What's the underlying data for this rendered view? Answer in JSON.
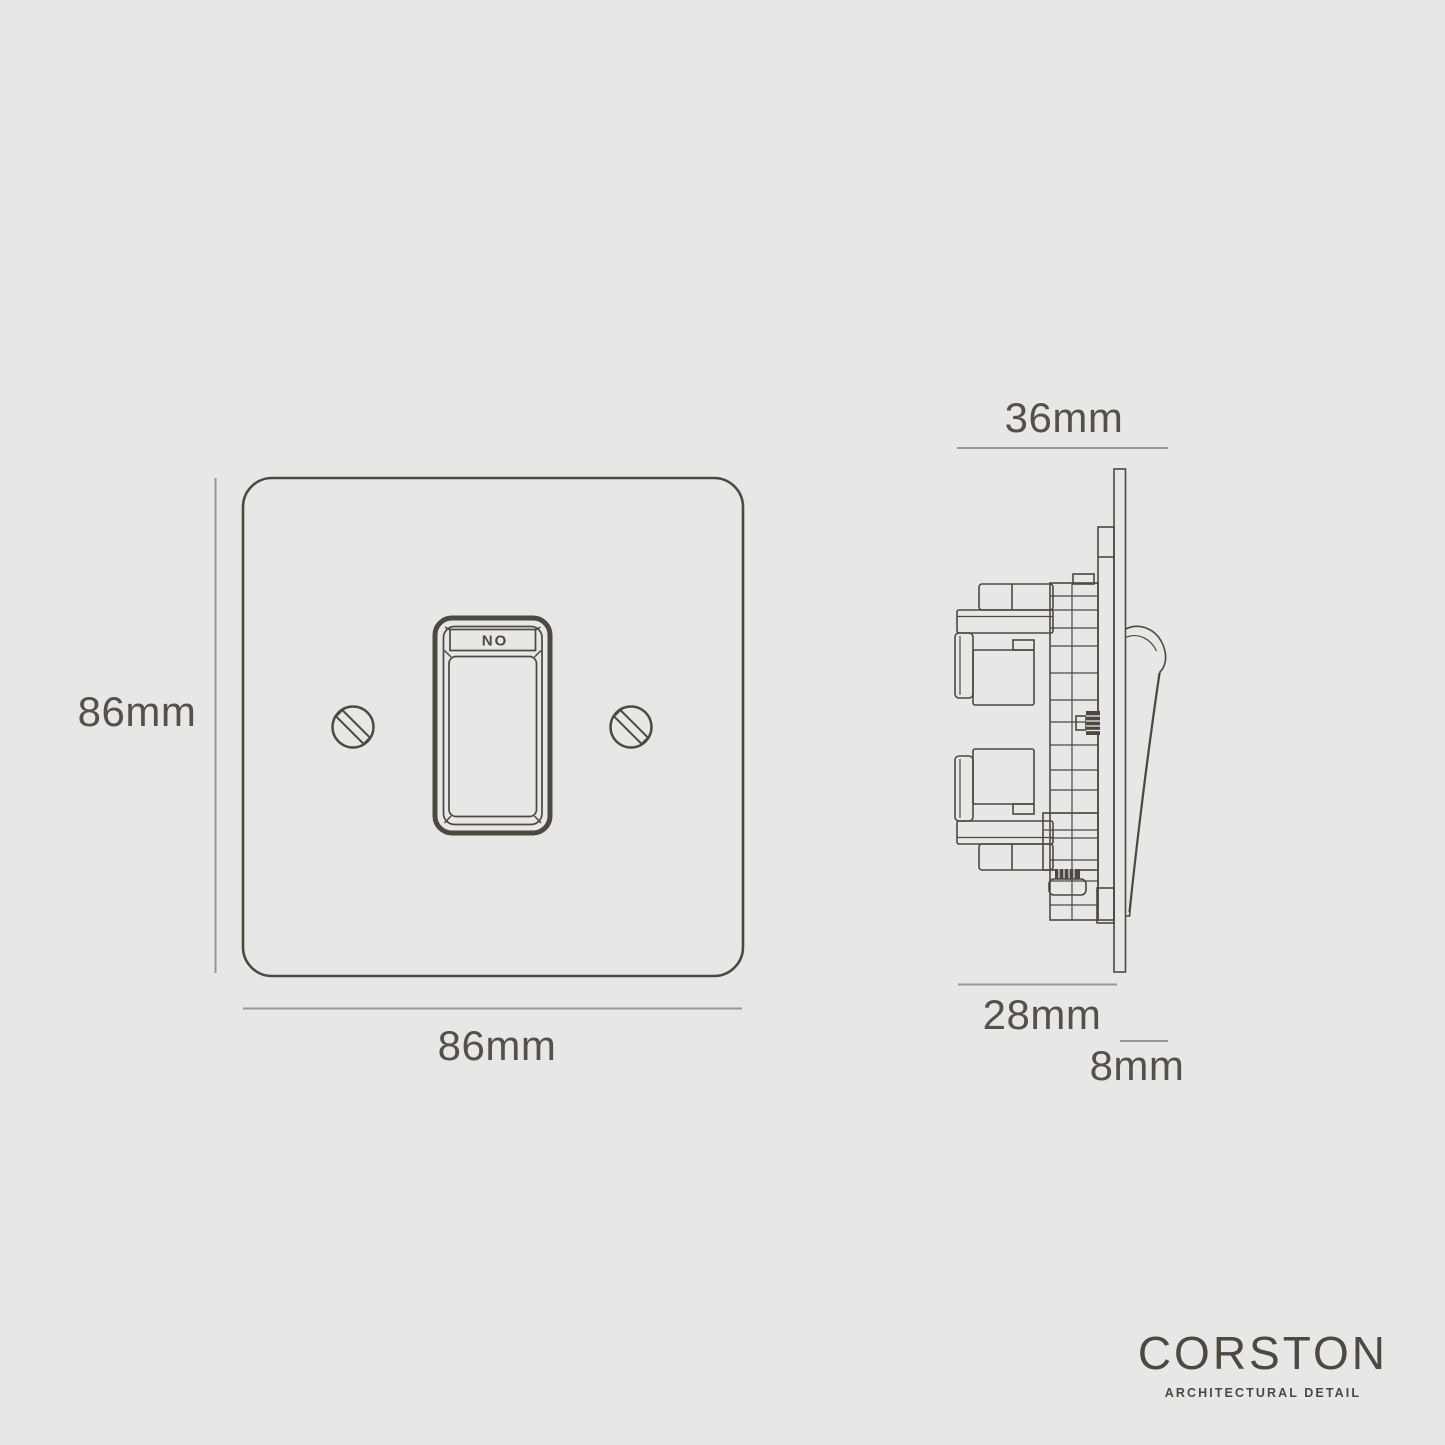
{
  "colors": {
    "background": "#e8e7e5",
    "line": "#4c4843",
    "dim_line": "#9a9792",
    "text": "#54504b"
  },
  "front_view": {
    "height_label": "86mm",
    "width_label": "86mm",
    "rocker_label": "ON"
  },
  "side_view": {
    "overall_depth_label": "36mm",
    "mechanism_depth_label": "28mm",
    "plate_depth_label": "8mm"
  },
  "logo": {
    "brand": "CORSTON",
    "tagline": "ARCHITECTURAL DETAIL"
  }
}
